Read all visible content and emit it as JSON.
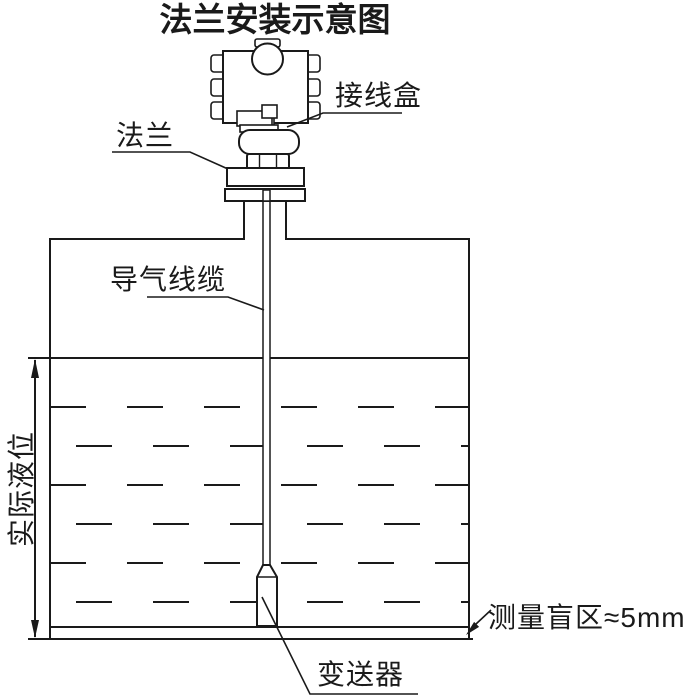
{
  "title": "法兰安装示意图",
  "labels": {
    "junction_box": "接线盒",
    "flange": "法兰",
    "air_cable": "导气线缆",
    "actual_level": "实际液位",
    "transmitter": "变送器",
    "blind_zone": "测量盲区≈5mm"
  },
  "diagram": {
    "type": "installation-schematic",
    "components": [
      "junction-box",
      "flange",
      "nozzle",
      "tank",
      "air-guide-cable",
      "probe-transmitter"
    ],
    "blind_zone_value": "≈5mm"
  },
  "colors": {
    "line": "#1a1a1a",
    "background": "#ffffff"
  }
}
